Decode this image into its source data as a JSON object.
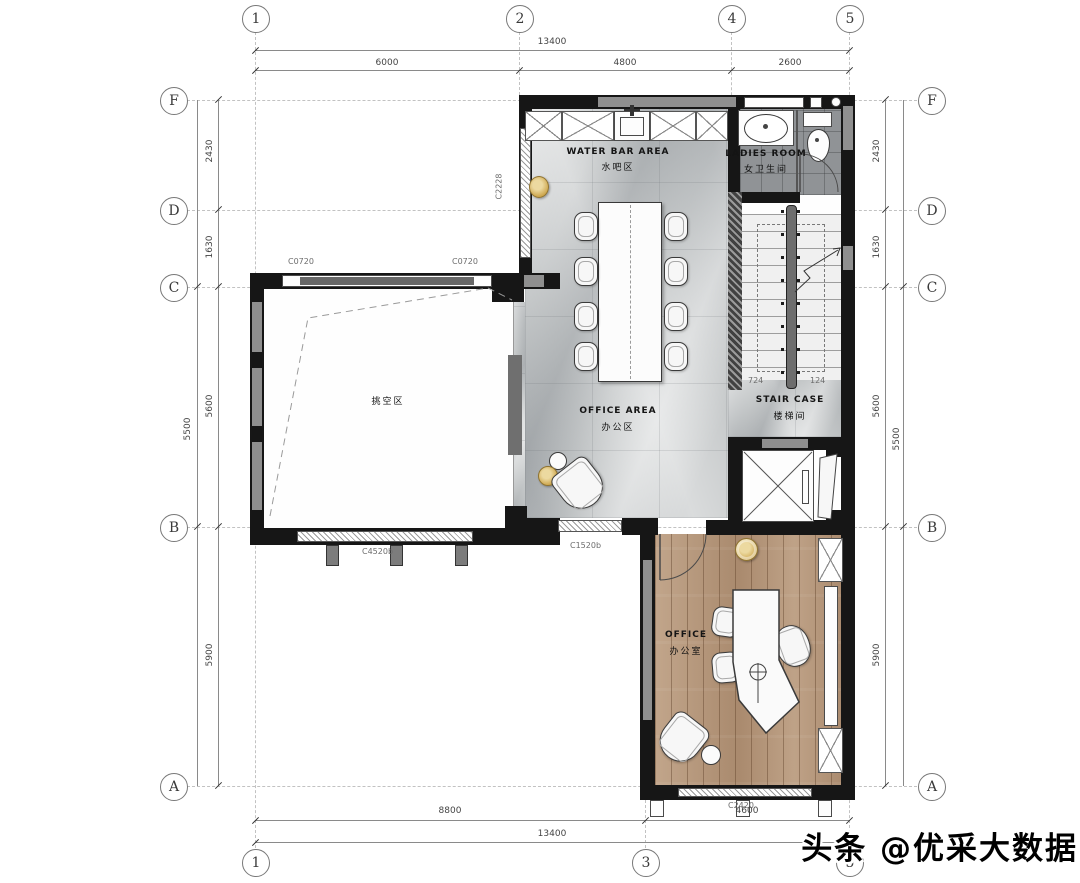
{
  "watermark": "头条 @优采大数据",
  "grid": {
    "top": [
      "1",
      "2",
      "4",
      "5"
    ],
    "bottom": [
      "1",
      "3",
      "5"
    ],
    "rows": [
      "F",
      "D",
      "C",
      "B",
      "A"
    ]
  },
  "dims": {
    "top_total": "13400",
    "top_1_2": "6000",
    "top_2_4": "4800",
    "top_4_5": "2600",
    "bottom_1_3": "8800",
    "bottom_3_5": "4600",
    "bottom_total": "13400",
    "row_f_d": "2430",
    "row_d_c": "1630",
    "row_c_b": "5600",
    "row_b_a": "5900",
    "row_outer": "5500",
    "stair_left": "724",
    "stair_right": "124"
  },
  "rooms": {
    "water_bar": {
      "en": "WATER BAR AREA",
      "cn": "水吧区"
    },
    "ladies": {
      "en": "LADIES ROOM",
      "cn": "女卫生间"
    },
    "office_area": {
      "en": "OFFICE AREA",
      "cn": "办公区"
    },
    "stair": {
      "en": "STAIR CASE",
      "cn": "楼梯间"
    },
    "office": {
      "en": "OFFICE",
      "cn": "办公室"
    },
    "void": {
      "cn": "挑空区"
    }
  },
  "tags": {
    "c0720_left": "C0720",
    "c0720_right": "C0720",
    "c2228": "C2228",
    "c4520b": "C4520b",
    "c1520b": "C1520b",
    "c2420": "C2420"
  },
  "colors": {
    "wall": "#161616",
    "marble_floor": "#c6c9ca",
    "wood_floor": "#b29376",
    "tile_floor": "#909396",
    "gold_accent": "#d4b96a"
  }
}
